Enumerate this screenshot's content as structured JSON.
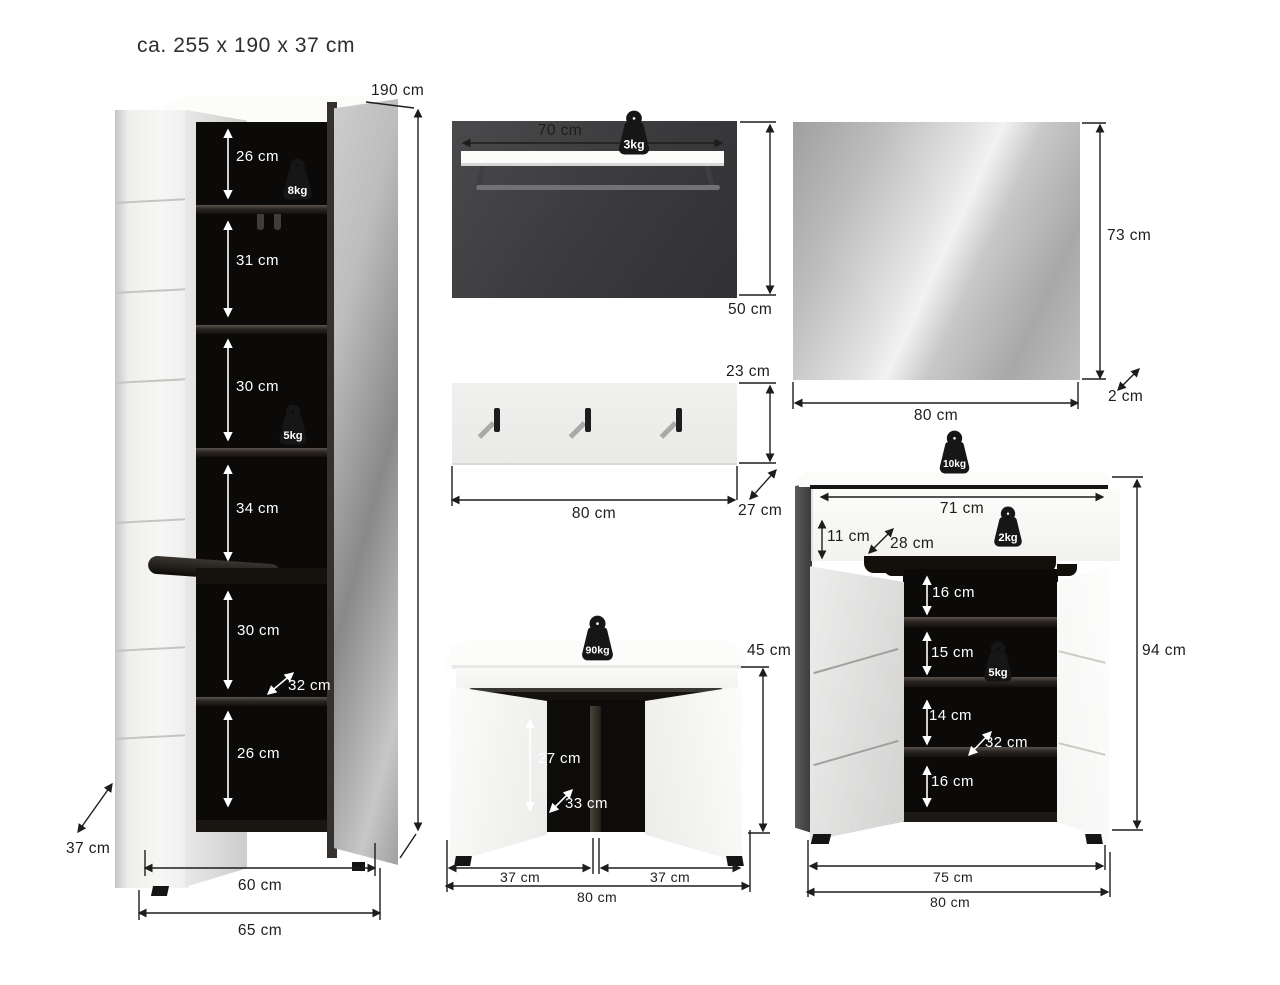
{
  "title": "ca. 255 x 190 x 37 cm",
  "colors": {
    "dimension_line": "#1d1d1b",
    "interior_black": "#0b0a09",
    "panel_dark": "#3e3e40",
    "furniture_white": "#fbfbfa",
    "weight_icon": "#161616"
  },
  "wardrobe": {
    "height": "190 cm",
    "sections": [
      "26 cm",
      "31 cm",
      "30 cm",
      "34 cm",
      "30 cm",
      "26 cm"
    ],
    "load_top": "8kg",
    "load_mid": "5kg",
    "inner_depth": "32 cm",
    "depth": "37 cm",
    "width_inner": "60 cm",
    "width_outer": "65 cm"
  },
  "wall_shelf": {
    "width": "70 cm",
    "load": "3kg",
    "height": "50 cm"
  },
  "coat_rack": {
    "height": "23 cm",
    "width": "80 cm",
    "depth": "27 cm"
  },
  "mirror": {
    "height": "73 cm",
    "width": "80 cm",
    "depth": "2 cm"
  },
  "bench": {
    "load": "90kg",
    "height": "45 cm",
    "inner_height": "27 cm",
    "inner_depth": "33 cm",
    "width_left": "37 cm",
    "width_right": "37 cm",
    "width": "80 cm"
  },
  "shoe_cabinet": {
    "load_top": "10kg",
    "drawer_width": "71 cm",
    "drawer_height": "11 cm",
    "drawer_depth": "28 cm",
    "load_drawer": "2kg",
    "shelves": [
      "16 cm",
      "15 cm",
      "14 cm",
      "16 cm"
    ],
    "load_shelf": "5kg",
    "inner_depth": "32 cm",
    "height": "94 cm",
    "width_inner": "75 cm",
    "width_outer": "80 cm"
  }
}
